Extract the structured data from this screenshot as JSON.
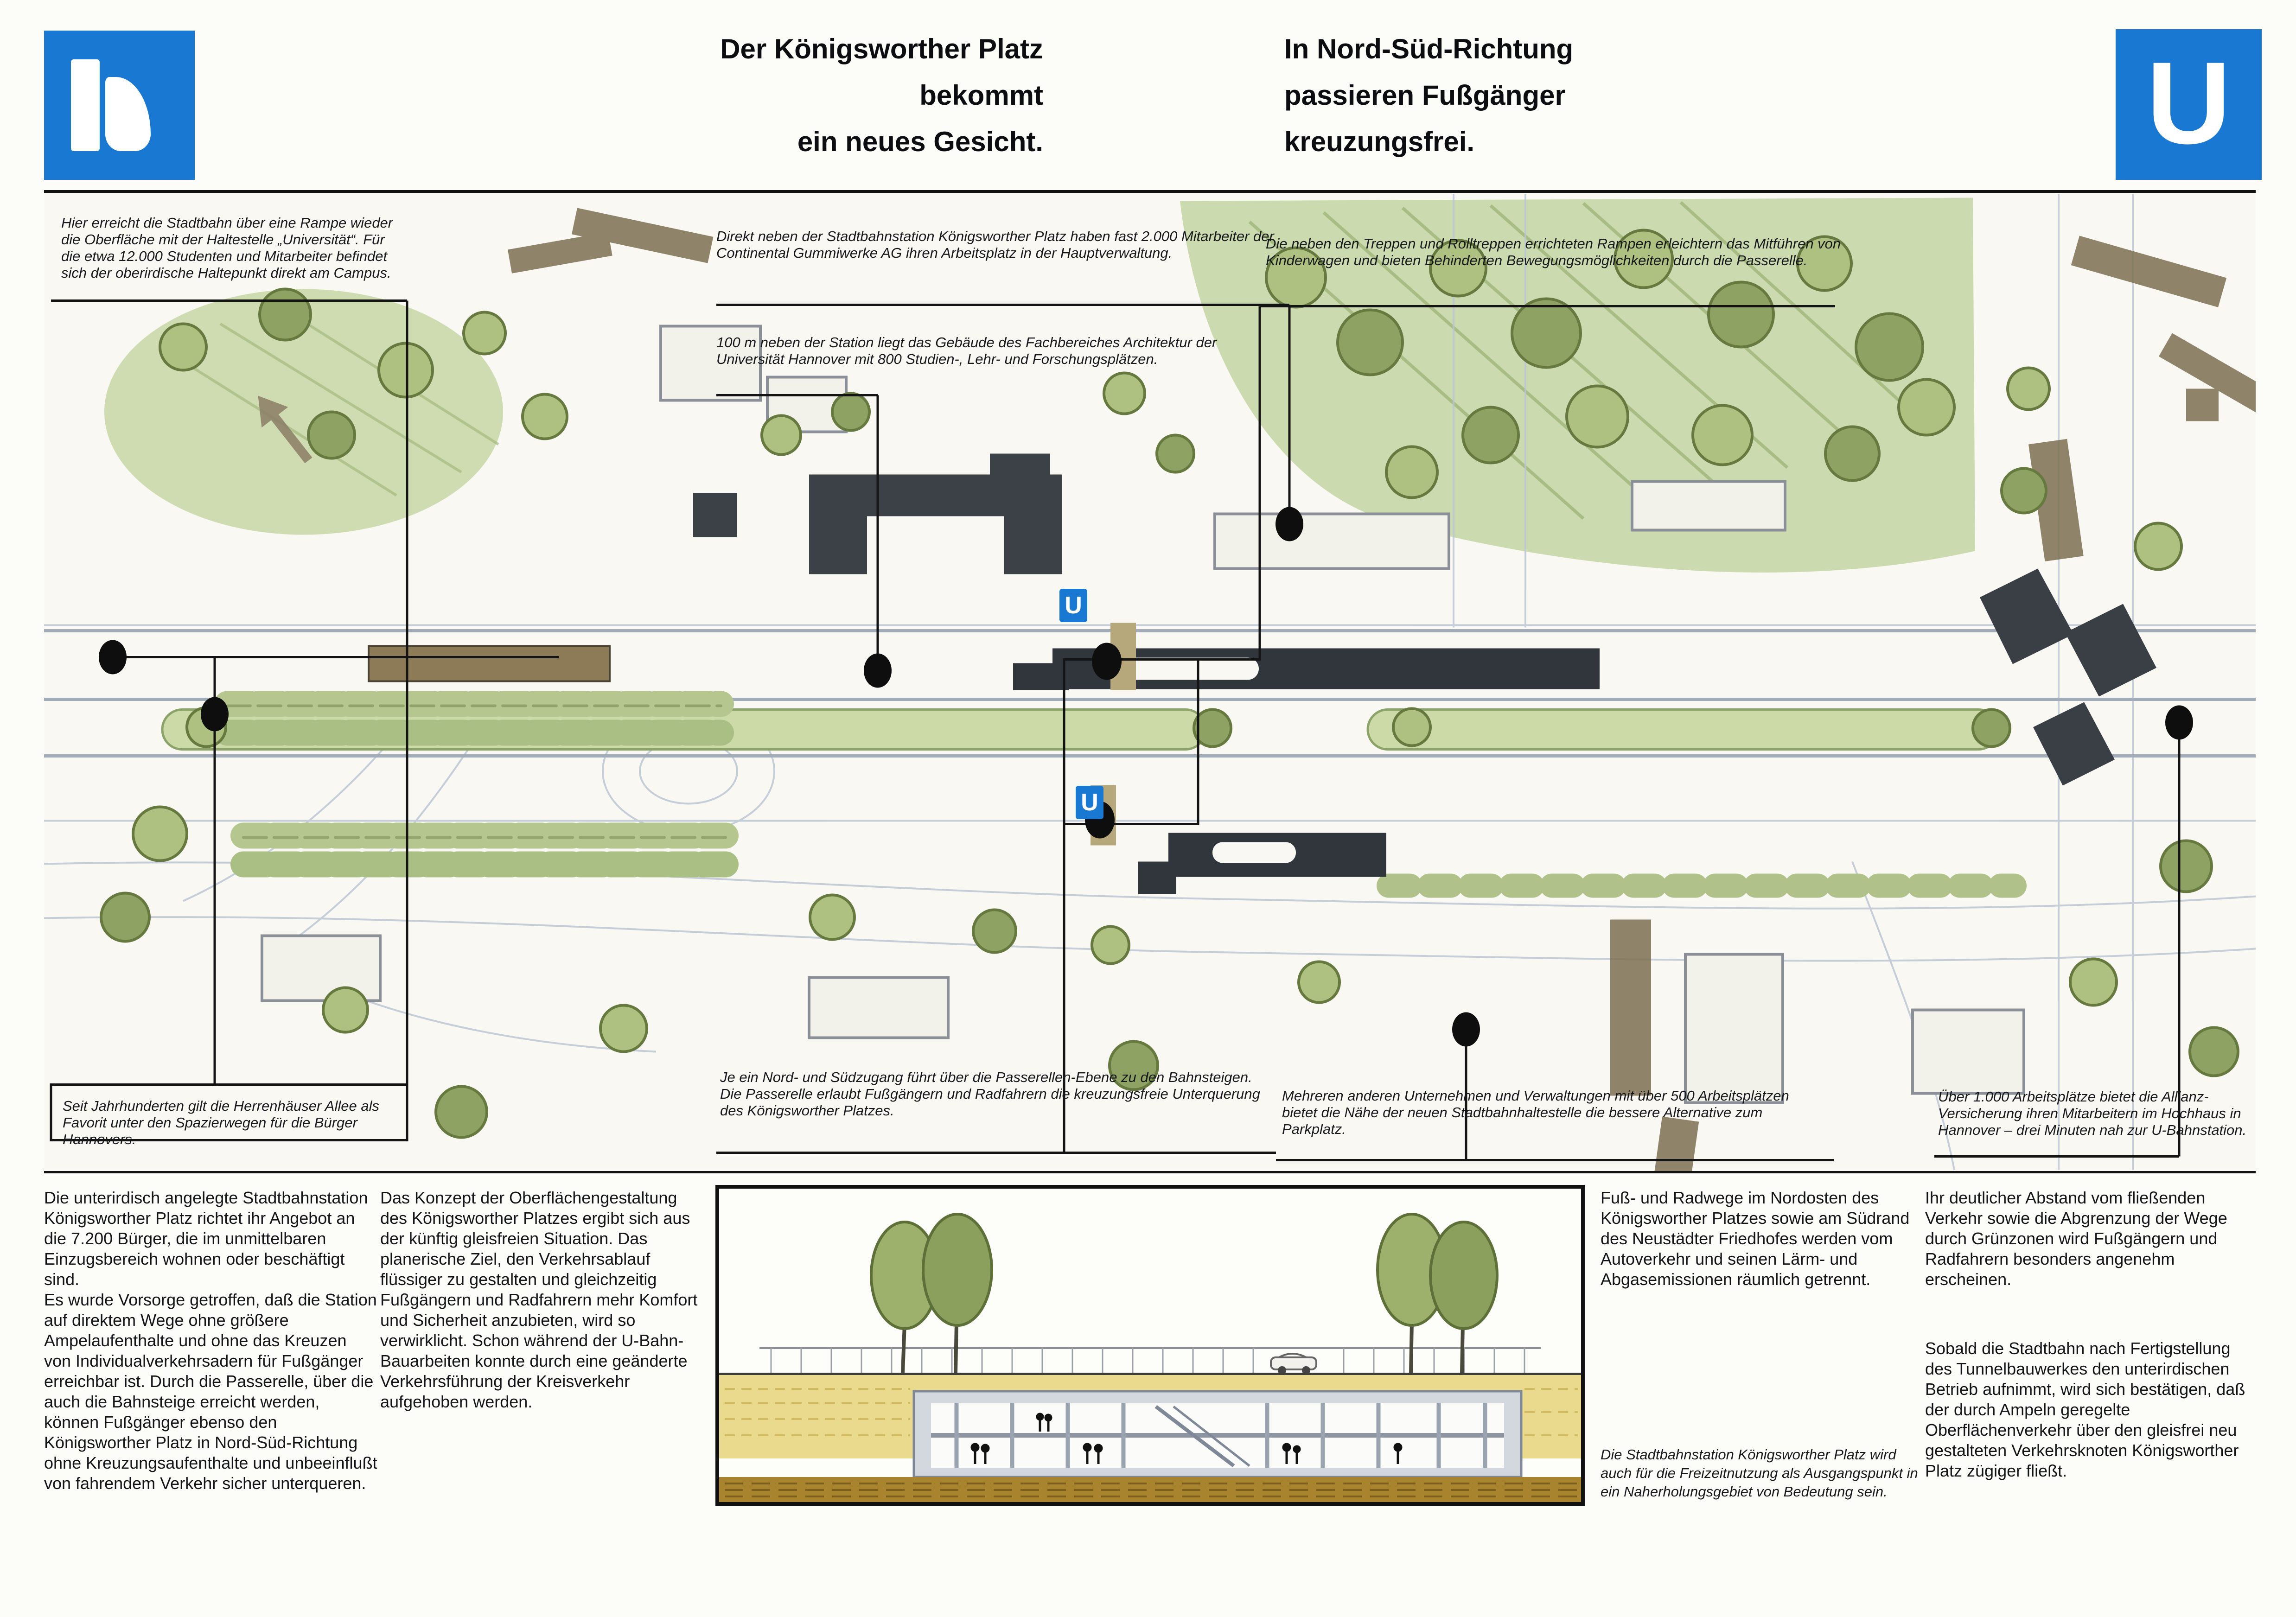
{
  "header": {
    "uestra_logo": "uestra-brand-mark",
    "ubahn_logo_letter": "U",
    "title_left_lines": [
      "Der Königsworther Platz",
      "bekommt",
      "ein neues Gesicht."
    ],
    "title_right_lines": [
      "In Nord-Süd-Richtung",
      "passieren Fußgänger",
      "kreuzungsfrei."
    ]
  },
  "colors": {
    "brand_blue": "#1878d2",
    "map_green": "#c3d2a3",
    "soil_yellow": "#e9da8e",
    "earth_brown": "#a8842e"
  },
  "map": {
    "u_marker_label": "U",
    "annotations": [
      {
        "id": "rampe-universitaet",
        "text": "Hier erreicht die Stadtbahn über eine Rampe wieder die Oberfläche mit der Haltestelle „Universität“. Für die etwa 12.000 Studenten und Mitarbeiter befindet sich der oberirdische Haltepunkt direkt am Campus."
      },
      {
        "id": "continental",
        "text": "Direkt neben der Stadtbahnstation Königsworther Platz haben fast 2.000 Mitarbeiter der Continental Gummiwerke AG ihren Arbeitsplatz in der Hauptverwaltung."
      },
      {
        "id": "architektur-fakultaet",
        "text": "100 m neben der Station liegt das Gebäude des Fachbereiches Architektur der Universität Hannover mit 800 Studien-, Lehr- und Forschungsplätzen."
      },
      {
        "id": "rampen-passerelle",
        "text": "Die neben den Treppen und Rolltreppen errichteten Rampen erleichtern das Mitführen von Kinderwagen und bieten Behinderten Bewegungsmöglichkeiten durch die Passerelle."
      },
      {
        "id": "herrenhaeuser-allee",
        "text": "Seit Jahrhunderten gilt die Herrenhäuser Allee als Favorit unter den Spazierwegen für die Bürger Hannovers."
      },
      {
        "id": "nord-sued-zugang",
        "text": "Je ein Nord- und Südzugang führt über die Passerellen-Ebene zu den Bahnsteigen. Die Passerelle erlaubt Fußgängern und Radfahrern die kreuzungsfreie Unterquerung des Königsworther Platzes."
      },
      {
        "id": "unternehmen-parkplatz",
        "text": "Mehreren anderen Unternehmen und Verwaltungen mit über 500 Arbeitsplätzen bietet die Nähe der neuen Stadtbahnhaltestelle die bessere Alternative zum Parkplatz."
      },
      {
        "id": "allianz-hochhaus",
        "text": "Über 1.000 Arbeitsplätze bietet die Allianz-Versicherung ihren Mitarbeitern im Hochhaus in Hannover – drei Minuten nah zur U-Bahnstation."
      }
    ]
  },
  "body": {
    "col1_p1": "Die unterirdisch angelegte Stadtbahnstation Königsworther Platz richtet ihr Angebot an die 7.200 Bürger, die im unmittelbaren Einzugsbereich wohnen oder beschäftigt sind.",
    "col1_p2": "Es wurde Vorsorge getroffen, daß die Station auf direktem Wege ohne größere Ampelaufenthalte und ohne das Kreuzen von Individualverkehrsadern für Fußgänger erreichbar ist. Durch die Passerelle, über die auch die Bahnsteige erreicht werden, können Fußgänger ebenso den Königsworther Platz in Nord-Süd-Richtung ohne Kreuzungsaufenthalte und unbeeinflußt von fahrendem Verkehr sicher unterqueren.",
    "col2_p1": "Das Konzept der Oberflächengestaltung des Königsworther Platzes ergibt sich aus der künftig gleisfreien Situation. Das planerische Ziel, den Verkehrsablauf flüssiger zu gestalten und gleichzeitig Fußgängern und Radfahrern mehr Komfort und Sicherheit anzubieten, wird so verwirklicht. Schon während der U-Bahn-Bauarbeiten konnte durch eine geänderte Verkehrsführung der Kreisverkehr aufgehoben werden.",
    "col3_p1": "Fuß- und Radwege im Nordosten des Königsworther Platzes sowie am Südrand des Neustädter Friedhofes werden vom Autoverkehr und seinen Lärm- und Abgasemissionen räumlich getrennt.",
    "figure_caption": "Die Stadtbahnstation Königsworther Platz wird auch für die Freizeitnutzung als Ausgangspunkt in ein Naherholungsgebiet von Bedeutung sein.",
    "col4_p1": "Ihr deutlicher Abstand vom fließenden Verkehr sowie die Abgrenzung der Wege durch Grünzonen wird Fußgängern und Radfahrern besonders angenehm erscheinen.",
    "col4_p2": "Sobald die Stadtbahn nach Fertigstellung des Tunnelbauwerkes den unterirdischen Betrieb aufnimmt, wird sich bestätigen, daß der durch Ampeln geregelte Oberflächenverkehr über den gleisfrei neu gestalteten Verkehrsknoten Königsworther Platz zügiger fließt."
  }
}
